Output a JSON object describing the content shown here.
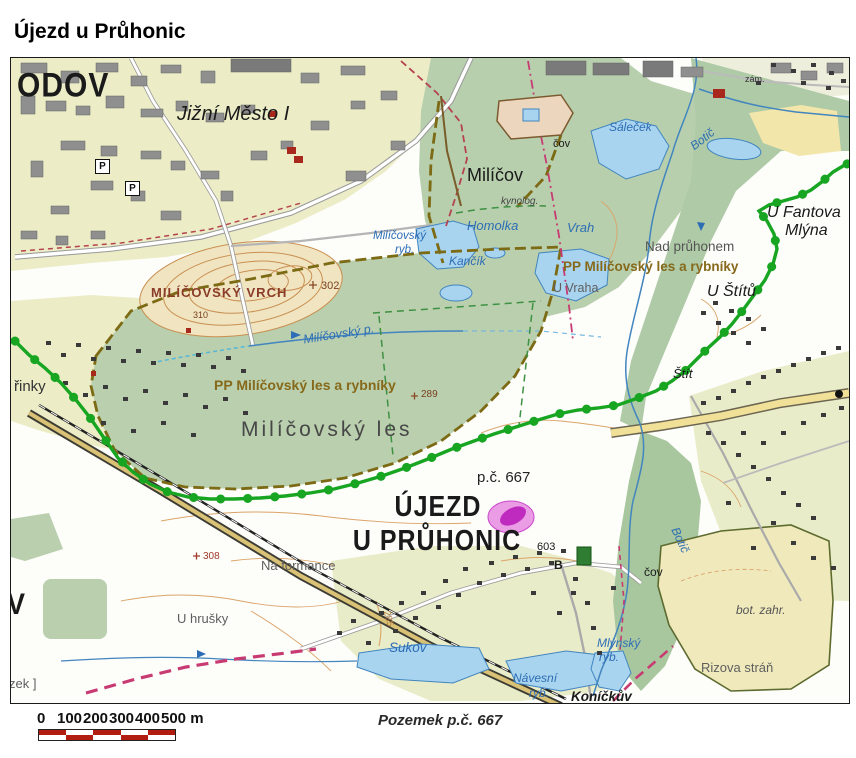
{
  "page_title": "Újezd u Průhonic",
  "caption": "Pozemek p.č. 667",
  "scale_bar": {
    "ticks": [
      "0",
      "100",
      "200",
      "300",
      "400",
      "500 m"
    ]
  },
  "icons": {
    "parking": "P"
  },
  "colors": {
    "trail_green": "#17a522",
    "boundary_magenta": "#c73a72",
    "parcel_highlight": "#bf2abf",
    "water_fill": "#a9d4ef",
    "forest_fill": "#b9cfad",
    "urban_fill": "#ecedc6",
    "field_fill": "#efe9bc",
    "pp_label_brown": "#86691a",
    "scale_red": "#b21d12"
  },
  "map": {
    "labels": {
      "odov": "ODOV",
      "jizni_mesto": "Jižní Město I",
      "milicov": "Milíčov",
      "cov_top": "čov",
      "kynolog": "kynolog.",
      "zam": "zám.",
      "salecek": "Sáleček",
      "botic_top": "Botič",
      "botic_bottom": "Botič",
      "homolka": "Homolka",
      "vrah": "Vrah",
      "kancik": "Kančík",
      "pp_right": "PP Milíčovský les a rybníky",
      "pp_left": "PP Milíčovský les a rybníky",
      "u_vraha": "U Vraha",
      "nad_pruhonem": "Nad průhonem",
      "u_fantova_line1": "U Fantova",
      "u_fantova_line2": "Mlýna",
      "u_stitu": "U Štítů",
      "stit": "Štít",
      "milicovsky_vrch": "MILÍČOVSKÝ VRCH",
      "elev_302": "302",
      "elev_310": "310",
      "elev_289": "289",
      "elev_308": "308",
      "elev_285": "285",
      "milicovsky_ryb_line1": "Milíčovský",
      "milicovsky_ryb_line2": "ryb.",
      "milicovsky_potok": "Milíčovský p.",
      "milicovsky_les": "Milíčovský les",
      "pc_667": "p.č. 667",
      "ujezd_line1": "ÚJEZD",
      "ujezd_line2": "U PRŮHONIC",
      "num_603": "603",
      "letter_b": "B",
      "na_formance": "Na formance",
      "katerinky_partial": "řinky",
      "v_partial": "V",
      "zek_partial": "zek ]",
      "u_hrusky": "U hrušky",
      "sukov": "Sukov",
      "navesni_line1": "Návesní",
      "navesni_line2": "ryb.",
      "konickuv": "Koníčkův",
      "mlynsky_line1": "Mlýnský",
      "mlynsky_line2": "ryb.",
      "cov_bottom": "čov",
      "bot_zahr": "bot. zahr.",
      "rizova_stran": "Rizova stráň"
    }
  }
}
